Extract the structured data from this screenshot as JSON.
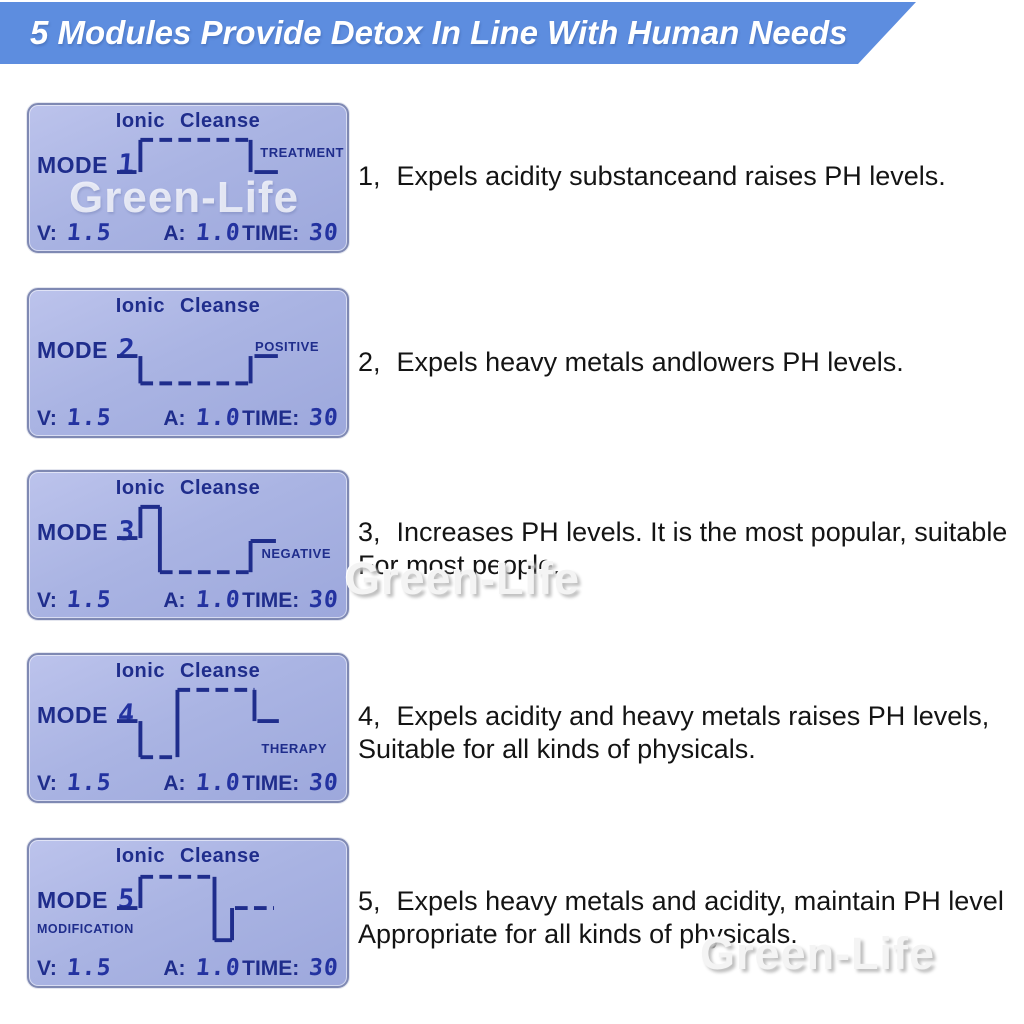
{
  "header": {
    "title": "5 Modules Provide Detox In Line With Human Needs"
  },
  "watermark": {
    "text": "Green-Life"
  },
  "colors": {
    "banner_bg": "#5d8ddf",
    "banner_text": "#ffffff",
    "lcd_bg": "#aab4e3",
    "lcd_text": "#1f2d8c",
    "desc_text": "#141414"
  },
  "lcd": {
    "title": "Ionic Cleanse",
    "mode_label": "MODE",
    "v_label": "V:",
    "v_value": "1.5",
    "a_label": "A:",
    "a_value": "1.0",
    "time_label": "TIME:",
    "time_value": "30"
  },
  "modes": [
    {
      "number": "1",
      "tag": "TREATMENT",
      "desc_num": "1、",
      "desc_text": "Expels acidity substanceand raises PH levels.",
      "waveform": [
        [
          0,
          38,
          20,
          38,
          0
        ],
        [
          24,
          38,
          24,
          5,
          0
        ],
        [
          24,
          5,
          137,
          5,
          1
        ],
        [
          137,
          5,
          137,
          38,
          0
        ],
        [
          141,
          38,
          165,
          38,
          0
        ]
      ]
    },
    {
      "number": "2",
      "tag": "POSITIVE",
      "desc_num": "2、",
      "desc_text": "Expels heavy metals andlowers PH levels.",
      "waveform": [
        [
          0,
          37,
          21,
          37,
          0
        ],
        [
          24,
          37,
          24,
          65,
          0
        ],
        [
          24,
          65,
          137,
          65,
          1
        ],
        [
          137,
          65,
          137,
          37,
          0
        ],
        [
          141,
          37,
          165,
          37,
          0
        ]
      ]
    },
    {
      "number": "3",
      "tag": "NEGATIVE",
      "desc_num": "3、",
      "desc_text": "Increases PH levels. It is the most popular, suitable\nFor most people.",
      "waveform": [
        [
          0,
          37,
          21,
          37,
          0
        ],
        [
          24,
          37,
          24,
          5,
          0
        ],
        [
          24,
          5,
          44,
          5,
          0
        ],
        [
          44,
          5,
          44,
          72,
          0
        ],
        [
          44,
          72,
          137,
          72,
          1
        ],
        [
          137,
          72,
          137,
          40,
          0
        ],
        [
          137,
          40,
          163,
          40,
          0
        ]
      ]
    },
    {
      "number": "4",
      "tag": "THERAPY",
      "desc_num": "4、",
      "desc_text": "Expels acidity and heavy metals raises PH levels,\nSuitable for all kinds of physicals.",
      "waveform": [
        [
          0,
          37,
          21,
          37,
          0
        ],
        [
          24,
          37,
          24,
          74,
          0
        ],
        [
          24,
          74,
          62,
          74,
          1
        ],
        [
          62,
          74,
          62,
          5,
          0
        ],
        [
          62,
          5,
          141,
          5,
          1
        ],
        [
          141,
          5,
          141,
          37,
          0
        ],
        [
          144,
          37,
          166,
          37,
          0
        ]
      ]
    },
    {
      "number": "5",
      "tag": "MODIFICATION",
      "desc_num": "5、",
      "desc_text": "Expels heavy metals and acidity, maintain PH level\nAppropriate for all kinds of physicals.",
      "waveform": [
        [
          0,
          39,
          21,
          39,
          0
        ],
        [
          24,
          39,
          24,
          7,
          0
        ],
        [
          24,
          7,
          100,
          7,
          1
        ],
        [
          100,
          7,
          100,
          72,
          0
        ],
        [
          100,
          72,
          118,
          72,
          0
        ],
        [
          118,
          72,
          118,
          39,
          0
        ],
        [
          121,
          39,
          161,
          39,
          1
        ]
      ]
    }
  ]
}
